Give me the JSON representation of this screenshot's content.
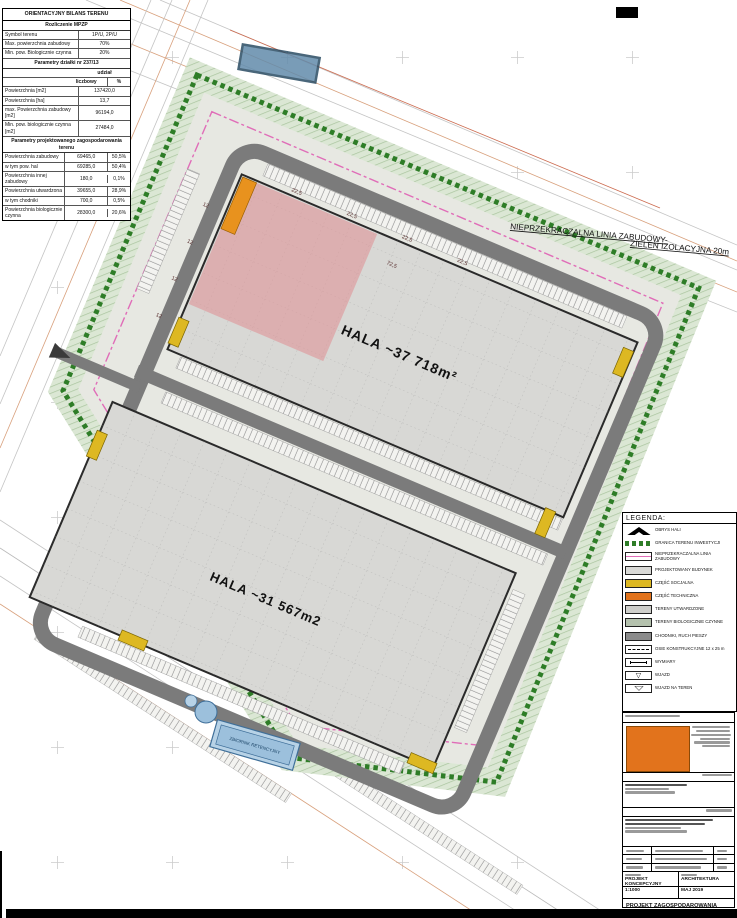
{
  "balance": {
    "title": "ORIENTACYJNY BILANS TERENU",
    "s1": "Rozliczenie MPZP",
    "rows1": [
      {
        "l": "Symbol terenu",
        "v": "1P/U, 2P/U"
      },
      {
        "l": "Max. powierzchnia zabudowy",
        "v": "70%"
      },
      {
        "l": "Min. pow. Biologicznie czynna",
        "v": "20%"
      }
    ],
    "s2": "Parametry działki nr 237/13",
    "udzial": "udział",
    "h_licz": "liczbowy",
    "h_pct": "%",
    "rows2": [
      {
        "l": "Powierzchnia [m2]",
        "v": "137420,0"
      },
      {
        "l": "Powierzchnia [ha]",
        "v": "13,7"
      },
      {
        "l": "max. Powierzchnia zabudowy [m2]",
        "v": "96194,0"
      },
      {
        "l": "Min. pow. biologicznie czynna [m2]",
        "v": "27484,0"
      }
    ],
    "s3": "Parametry projektowanego zagospodarowania terenu",
    "rows3": [
      {
        "l": "Powierzchnia zabudowy",
        "v": "69465,0",
        "p": "50,5%"
      },
      {
        "l": "w tym pow. hal",
        "v": "69285,0",
        "p": "50,4%"
      },
      {
        "l": "Powierzchnia innej zabudowy",
        "v": "180,0",
        "p": "0,1%"
      },
      {
        "l": "Powierzchnia utwardzona",
        "v": "39655,0",
        "p": "28,9%"
      },
      {
        "l": "w tym chodniki",
        "v": "700,0",
        "p": "0,5%"
      },
      {
        "l": "Powierzchnia biologicznie czynna",
        "v": "28300,0",
        "p": "20,6%"
      }
    ]
  },
  "plan": {
    "hala1": "HALA  ~37 718m²",
    "hala2": "HALA  ~31 567m2",
    "linia": "NIEPRZEKRACZALNA LINIA ZABUDOWY-",
    "zielen": "ZIELEŃ IZOLACYJNA 20m",
    "zbiornik": "ZBIORNIK RETENCYJNY",
    "dims": [
      "22,5",
      "22,5",
      "22,5",
      "22,5",
      "72,5",
      "12",
      "12",
      "12",
      "12"
    ]
  },
  "legend": {
    "title": "LEGENDA:",
    "items": [
      {
        "label": "OBRYS HALI"
      },
      {
        "label": "GRANICA TERENU INWESTYCJI"
      },
      {
        "label": "NIEPRZEKRACZALNA LINIA ZABUDOWY"
      },
      {
        "label": "PROJEKTOWANY BUDYNEK"
      },
      {
        "label": "CZĘŚĆ SOCJALNA"
      },
      {
        "label": "CZĘŚĆ TECHNICZNA"
      },
      {
        "label": "TERENY UTWARDZONE"
      },
      {
        "label": "TERENY BIOLOGICZNIE CZYNNE"
      },
      {
        "label": "CHODNIKI, RUCH PIESZY"
      },
      {
        "label": "OSIE KONSTRUKCYJNE 12 x 25 m"
      },
      {
        "label": "WYMIARY"
      },
      {
        "label": "WJAZD"
      },
      {
        "label": "WJAZD NA TEREN"
      }
    ]
  },
  "titleblock": {
    "stadium": "PROJEKT KONCEPCYJNY",
    "branza": "ARCHITEKTURA",
    "skala": "1:1000",
    "data": "MAJ 2019",
    "tytul": "PROJEKT ZAGOSPODAROWANIA TERENU",
    "nr": "Z_01"
  },
  "colors": {
    "road": "#7b7b7b",
    "hall": "#d8d8d5",
    "green_border": "#2e7d27",
    "build_line_pink": "#e06db8",
    "social_yellow": "#ddb822",
    "technical_orange": "#e2731c"
  }
}
